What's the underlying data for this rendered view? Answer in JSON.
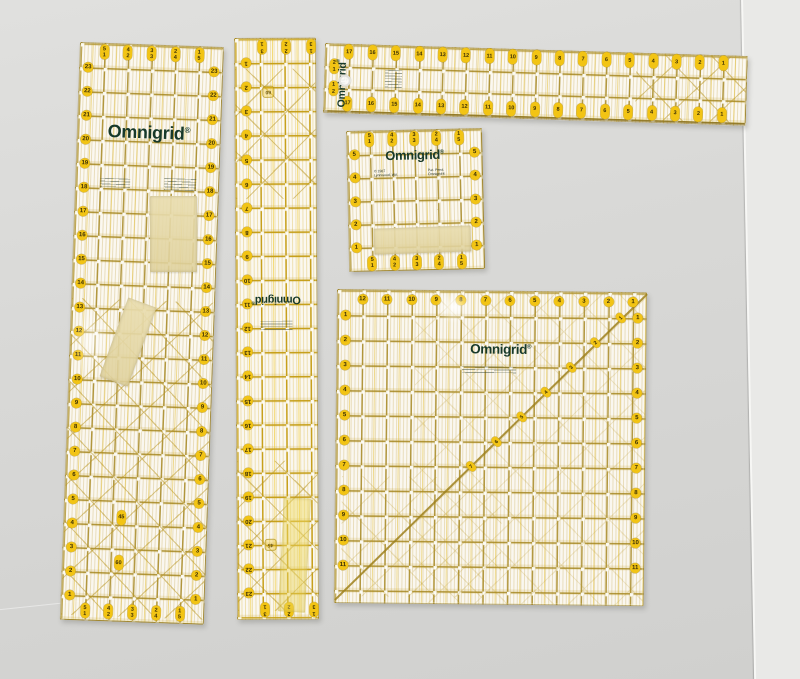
{
  "scene": {
    "description": "Photograph of five translucent Omnigrid quilting rulers lying on a light gray surface with a vertical seam on the right; several pieces of masking tape stuck to the rulers",
    "surface": "light gray tabletop",
    "colors": {
      "grid_gold": "#a3841c",
      "marker_yellow": "#f2c414",
      "logo_green": "#17392a",
      "tape_beige": "#e4d6a4",
      "background_gray": "#d8d8d6",
      "seam_light": "#e9e9e7"
    }
  },
  "rulers": [
    {
      "id": "rA",
      "name": "large 6x24 inch ruler",
      "brand": "Omnigrid",
      "reg": "®",
      "pitch_x": 23.7,
      "pitch_y": 24,
      "markers": [
        {
          "kind": "row",
          "shape": "pill",
          "y_in": 0.34,
          "x_in": [
            1,
            2,
            3,
            4,
            5
          ],
          "labels": [
            "5\n1",
            "4\n2",
            "3\n3",
            "2\n4",
            "1\n5"
          ]
        },
        {
          "kind": "row",
          "shape": "pill",
          "y_in": 23.64,
          "x_in": [
            1,
            2,
            3,
            4,
            5
          ],
          "labels": [
            "5\n1",
            "4\n2",
            "3\n3",
            "2\n4",
            "1\n5"
          ]
        },
        {
          "kind": "column",
          "shape": "circle",
          "x_in": 0.34,
          "y_start": 1,
          "y_step": 1,
          "count": 23,
          "n_start": 23,
          "n_step": -1
        },
        {
          "kind": "column",
          "shape": "circle",
          "x_in": 5.66,
          "y_start": 1,
          "y_step": 1,
          "count": 23,
          "n_start": 23,
          "n_step": -1
        },
        {
          "kind": "single",
          "shape": "pill",
          "x_in": 2.4,
          "y_in": 19.7,
          "label": "45"
        },
        {
          "kind": "single",
          "shape": "pill",
          "x_in": 2.35,
          "y_in": 21.6,
          "label": "60"
        }
      ]
    },
    {
      "id": "rB",
      "name": "narrow 3x24 inch ruler placed upside down",
      "brand": "Omnigrid",
      "reg": "®",
      "pitch_x": 24.6,
      "pitch_y": 24.1,
      "off_x": 2,
      "markers": [
        {
          "kind": "row",
          "shape": "pill",
          "y_in": 0.35,
          "x_in": [
            1,
            2,
            3
          ],
          "labels": [
            "3\n1",
            "2\n2",
            "1\n3"
          ]
        },
        {
          "kind": "row",
          "shape": "pill",
          "y_in": 23.7,
          "x_in": [
            1,
            2,
            3
          ],
          "labels": [
            "3\n1",
            "2\n2",
            "1\n3"
          ]
        },
        {
          "kind": "column",
          "shape": "circle",
          "x_in": 0.35,
          "y_start": 1,
          "y_step": 1,
          "count": 23,
          "n_start": 1,
          "n_step": 1
        },
        {
          "kind": "single",
          "shape": "sq",
          "x_in": 1.26,
          "y_in": 2.2,
          "label": "60"
        },
        {
          "kind": "single",
          "shape": "sq",
          "x_in": 1.26,
          "y_in": 21.0,
          "label": "45"
        }
      ]
    },
    {
      "id": "rC",
      "name": "long 3x18 inch horizontal ruler",
      "brand": "Omnigrid",
      "reg": "®",
      "pitch_x": 23.4,
      "pitch_y": 22,
      "markers": [
        {
          "kind": "row",
          "shape": "pill",
          "y_in": 0.32,
          "x_in": [
            1,
            2,
            3,
            4,
            5,
            6,
            7,
            8,
            9,
            10,
            11,
            12,
            13,
            14,
            15,
            16,
            17
          ],
          "labels": [
            "17",
            "16",
            "15",
            "14",
            "13",
            "12",
            "11",
            "10",
            "9",
            "8",
            "7",
            "6",
            "5",
            "4",
            "3",
            "2",
            "1"
          ]
        },
        {
          "kind": "row",
          "shape": "pill",
          "y_in": 2.68,
          "x_in": [
            1,
            2,
            3,
            4,
            5,
            6,
            7,
            8,
            9,
            10,
            11,
            12,
            13,
            14,
            15,
            16,
            17
          ],
          "labels": [
            "17",
            "16",
            "15",
            "14",
            "13",
            "12",
            "11",
            "10",
            "9",
            "8",
            "7",
            "6",
            "5",
            "4",
            "3",
            "2",
            "1"
          ]
        },
        {
          "kind": "single",
          "shape": "pill",
          "x_in": 0.38,
          "y_in": 1,
          "label": "2\n1"
        },
        {
          "kind": "single",
          "shape": "pill",
          "x_in": 0.38,
          "y_in": 2,
          "label": "1\n2"
        }
      ]
    },
    {
      "id": "rD",
      "name": "small 6x6 inch square ruler",
      "brand": "Omnigrid",
      "reg": "®",
      "fine_print_left": "© 1987\nLynnwood, WA",
      "fine_print_right": "Pat. Pend.\nOmnigrid®",
      "pitch_x": 22.3,
      "pitch_y": 23.2,
      "markers": [
        {
          "kind": "row",
          "shape": "pill",
          "y_in": 0.33,
          "x_in": [
            1,
            2,
            3,
            4,
            5
          ],
          "labels": [
            "5\n1",
            "4\n2",
            "3\n3",
            "2\n4",
            "1\n5"
          ]
        },
        {
          "kind": "row",
          "shape": "pill",
          "y_in": 5.67,
          "x_in": [
            1,
            2,
            3,
            4,
            5
          ],
          "labels": [
            "5\n1",
            "4\n2",
            "3\n3",
            "2\n4",
            "1\n5"
          ]
        },
        {
          "kind": "column",
          "shape": "circle",
          "x_in": 0.3,
          "y_start": 1,
          "y_step": 1,
          "count": 5,
          "n_start": 5,
          "n_step": -1
        },
        {
          "kind": "column",
          "shape": "circle",
          "x_in": 5.7,
          "y_start": 1,
          "y_step": 1,
          "count": 5,
          "n_start": 5,
          "n_step": -1
        }
      ]
    },
    {
      "id": "rE",
      "name": "large 12.5x12.5 inch square ruler",
      "brand": "Omnigrid",
      "reg": "®",
      "pitch_x": 24.6,
      "pitch_y": 25,
      "markers": [
        {
          "kind": "row",
          "shape": "circle",
          "y_in": 0.35,
          "x_in": [
            1,
            2,
            3,
            4,
            5,
            6,
            7,
            8,
            9,
            10,
            11,
            12
          ],
          "labels": [
            "12",
            "11",
            "10",
            "9",
            "8",
            "7",
            "6",
            "5",
            "4",
            "3",
            "2",
            "1"
          ]
        },
        {
          "kind": "column",
          "shape": "circle",
          "x_in": 0.32,
          "y_start": 1,
          "y_step": 1,
          "count": 11,
          "n_start": 1,
          "n_step": 1
        },
        {
          "kind": "column",
          "shape": "circle",
          "x_in": 12.2,
          "y_start": 1,
          "y_step": 1,
          "count": 11,
          "n_start": 1,
          "n_step": 1
        },
        {
          "kind": "diag",
          "shape": "dpill",
          "start_x": 11.5,
          "start_y": 1,
          "dx": -1,
          "dy": 1,
          "count": 7,
          "n_start": 1,
          "n_step": 1
        }
      ]
    }
  ],
  "tapes": [
    {
      "id": "t1",
      "label": "masking tape rectangle on 6x24 ruler"
    },
    {
      "id": "t2",
      "label": "slanted masking tape strip on 6x24 ruler"
    },
    {
      "id": "t3",
      "label": "masking tape strip on 6x6 ruler"
    },
    {
      "id": "t4",
      "label": "yellowed tape strip on narrow ruler"
    }
  ]
}
